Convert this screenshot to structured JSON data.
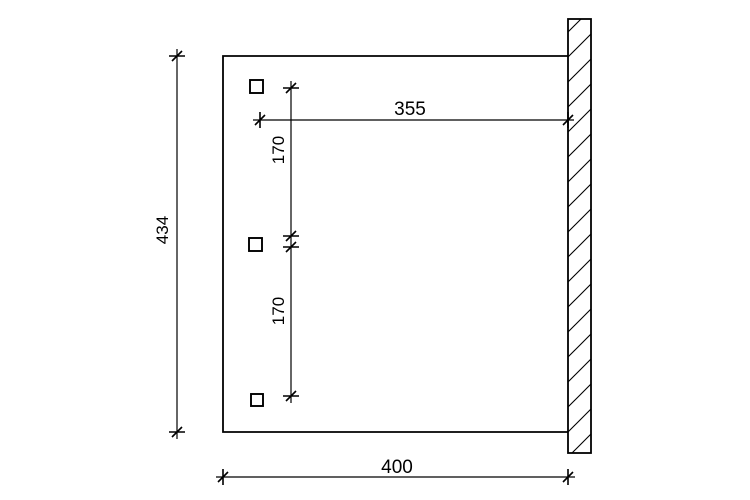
{
  "drawing": {
    "type": "technical-dimension-plan",
    "background_color": "#ffffff",
    "line_color": "#000000",
    "dimensions": {
      "overall_height": {
        "label": "434",
        "orientation": "vertical",
        "position": "left"
      },
      "top_width": {
        "label": "355",
        "orientation": "horizontal",
        "position": "top"
      },
      "post_spacing_upper": {
        "label": "170",
        "orientation": "vertical",
        "position": "center"
      },
      "post_spacing_lower": {
        "label": "170",
        "orientation": "vertical",
        "position": "center"
      },
      "bottom_width": {
        "label": "400",
        "orientation": "horizontal",
        "position": "bottom"
      }
    },
    "elements": {
      "posts_count": 3,
      "wall_style": "hatched-section",
      "canopy_outline": "rectangle-open-to-wall"
    }
  }
}
